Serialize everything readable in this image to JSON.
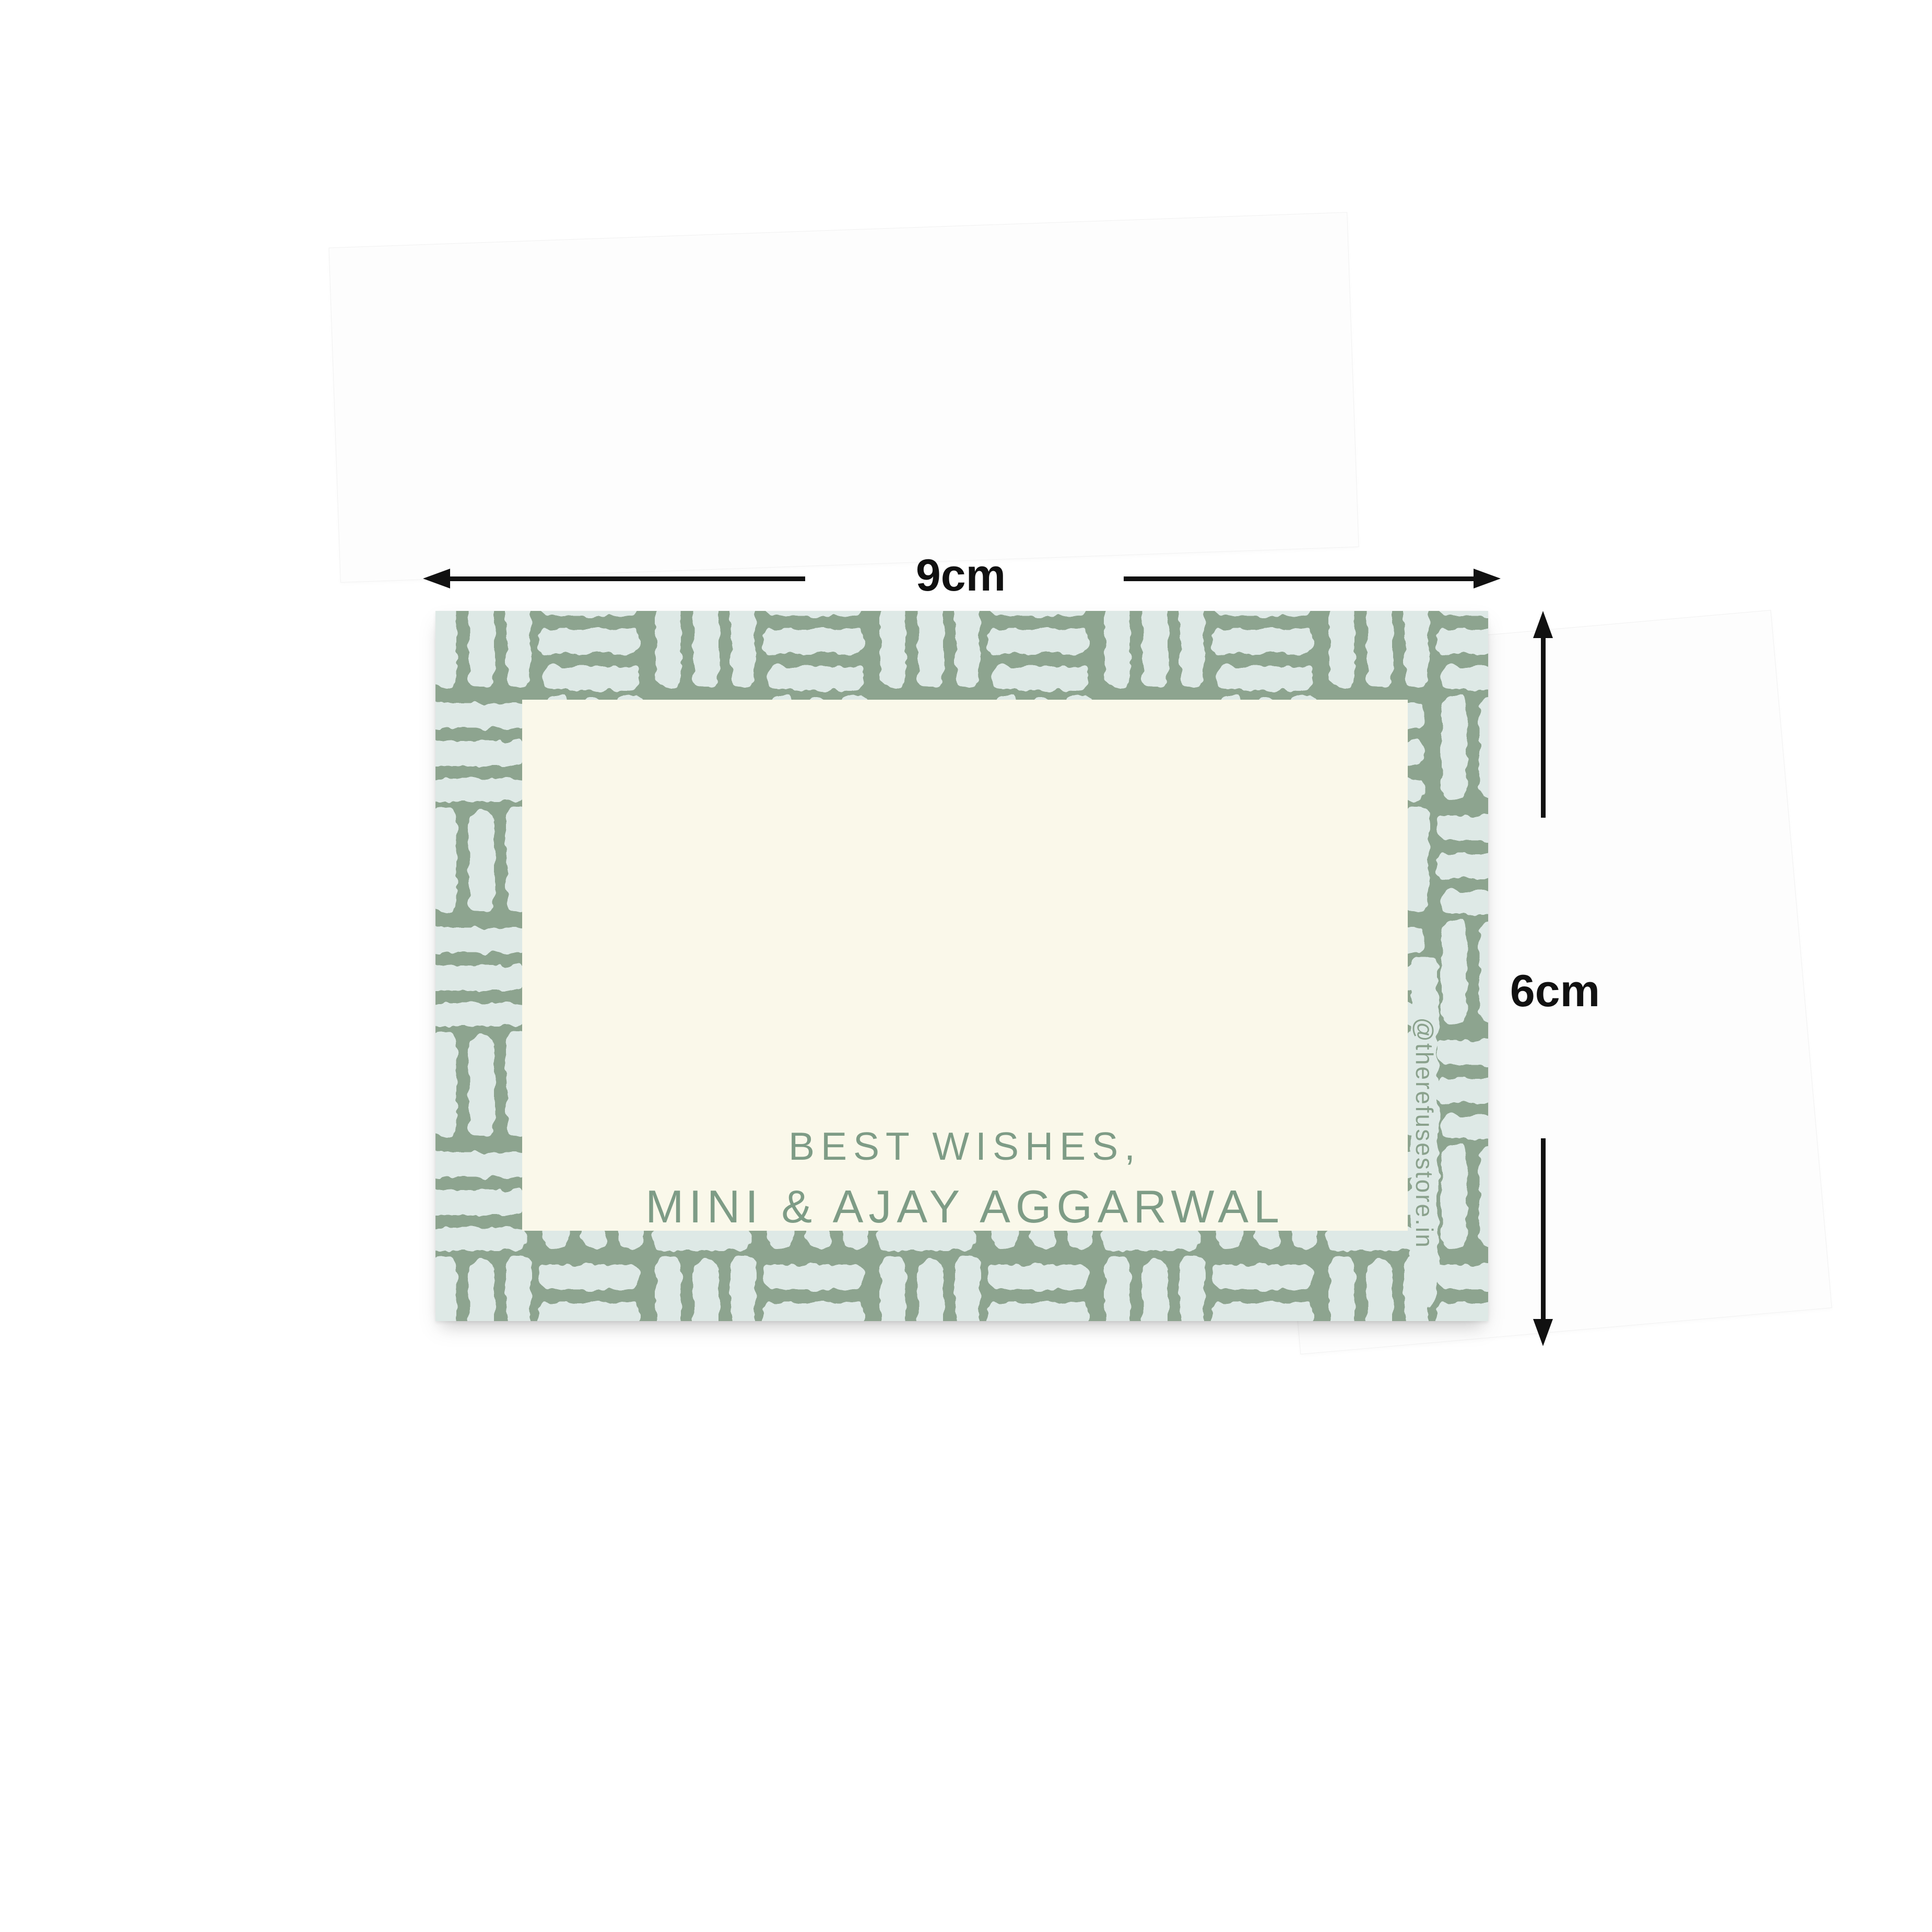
{
  "product_card": {
    "message_line1": "BEST WISHES,",
    "message_line2": "MINI & AJAY AGGARWAL",
    "watermark": "@therefusestore.in",
    "pattern": "hand-drawn basket-weave brush-stroke border",
    "colors": {
      "pattern_green": "#8da48f",
      "pattern_light_stroke": "#dee9e6",
      "panel_cream": "#faf8ea",
      "message_green": "#7e9c86",
      "watermark_green": "#8aa18c"
    }
  },
  "annotations": {
    "width_label": "9cm",
    "height_label": "6cm",
    "color": "#111111"
  }
}
